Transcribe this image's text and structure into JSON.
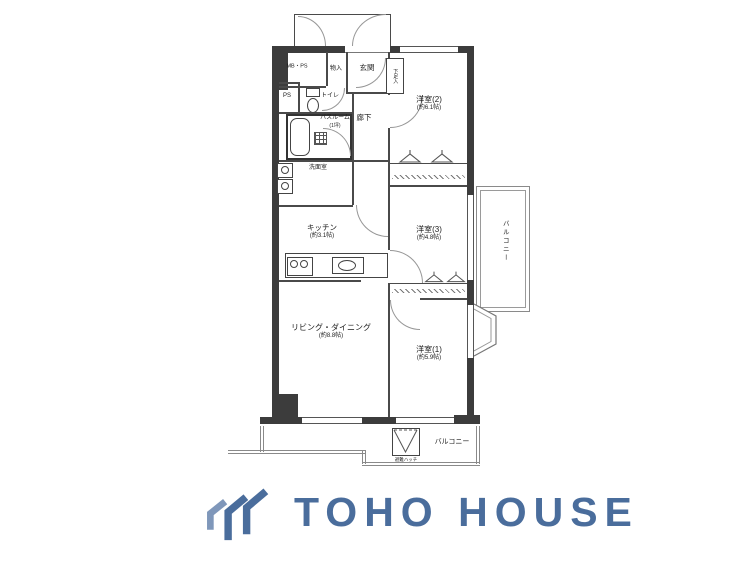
{
  "background": "#ffffff",
  "plan": {
    "wall_color": "#3c3c3c",
    "rooms": {
      "mbps": {
        "label": "MB・PS"
      },
      "monoire": {
        "label": "物入"
      },
      "genkan": {
        "label": "玄関"
      },
      "gesokuire": {
        "label": "下足入"
      },
      "ps": {
        "label": "PS"
      },
      "toilet": {
        "label": "トイレ"
      },
      "bath": {
        "label": "バスルーム",
        "size": "(1坪)"
      },
      "rouka": {
        "label": "廊下"
      },
      "senmen": {
        "label": "洗面室"
      },
      "kitchen": {
        "label": "キッチン",
        "size": "(約3.1帖)"
      },
      "yoshitsu2": {
        "label": "洋室(2)",
        "size": "(約6.1帖)"
      },
      "yoshitsu3": {
        "label": "洋室(3)",
        "size": "(約4.8帖)"
      },
      "yoshitsu1": {
        "label": "洋室(1)",
        "size": "(約5.9帖)"
      },
      "living": {
        "label": "リビング・ダイニング",
        "size": "(約8.8帖)"
      },
      "balcony_right": {
        "label": "バルコニー"
      },
      "balcony_bottom": {
        "label": "バルコニー"
      },
      "hatch": {
        "label": "避難ハッチ"
      }
    }
  },
  "brand": {
    "name": "TOHO HOUSE",
    "color": "#4a6d9c",
    "mark": "chevron-house-icon"
  }
}
